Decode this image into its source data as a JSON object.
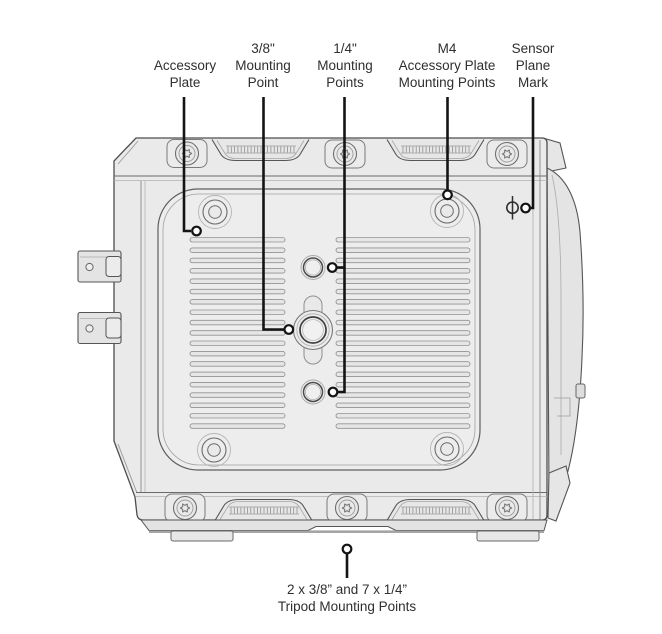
{
  "figure": {
    "subject": "Camera bottom view mounting points diagram",
    "labels": {
      "accessory_plate": [
        "Accessory",
        "Plate"
      ],
      "mount_3_8": [
        "3/8\"",
        "Mounting",
        "Point"
      ],
      "mount_1_4": [
        "1/4\"",
        "Mounting",
        "Points"
      ],
      "m4_points": [
        "M4",
        "Accessory Plate",
        "Mounting Points"
      ],
      "sensor_plane": [
        "Sensor",
        "Plane",
        "Mark"
      ],
      "tripod": [
        "2 x 3/8” and 7 x 1/4”",
        "Tripod Mounting Points"
      ]
    },
    "icons": {
      "sensor_plane_mark": "phi-circle-with-vertical-line"
    },
    "colors": {
      "background": "#ffffff",
      "body_fill": "#eaeaea",
      "plate_fill": "#ededed",
      "outline": "#4d4d4d",
      "leader": "#141414",
      "text": "#2f2f2f"
    }
  }
}
